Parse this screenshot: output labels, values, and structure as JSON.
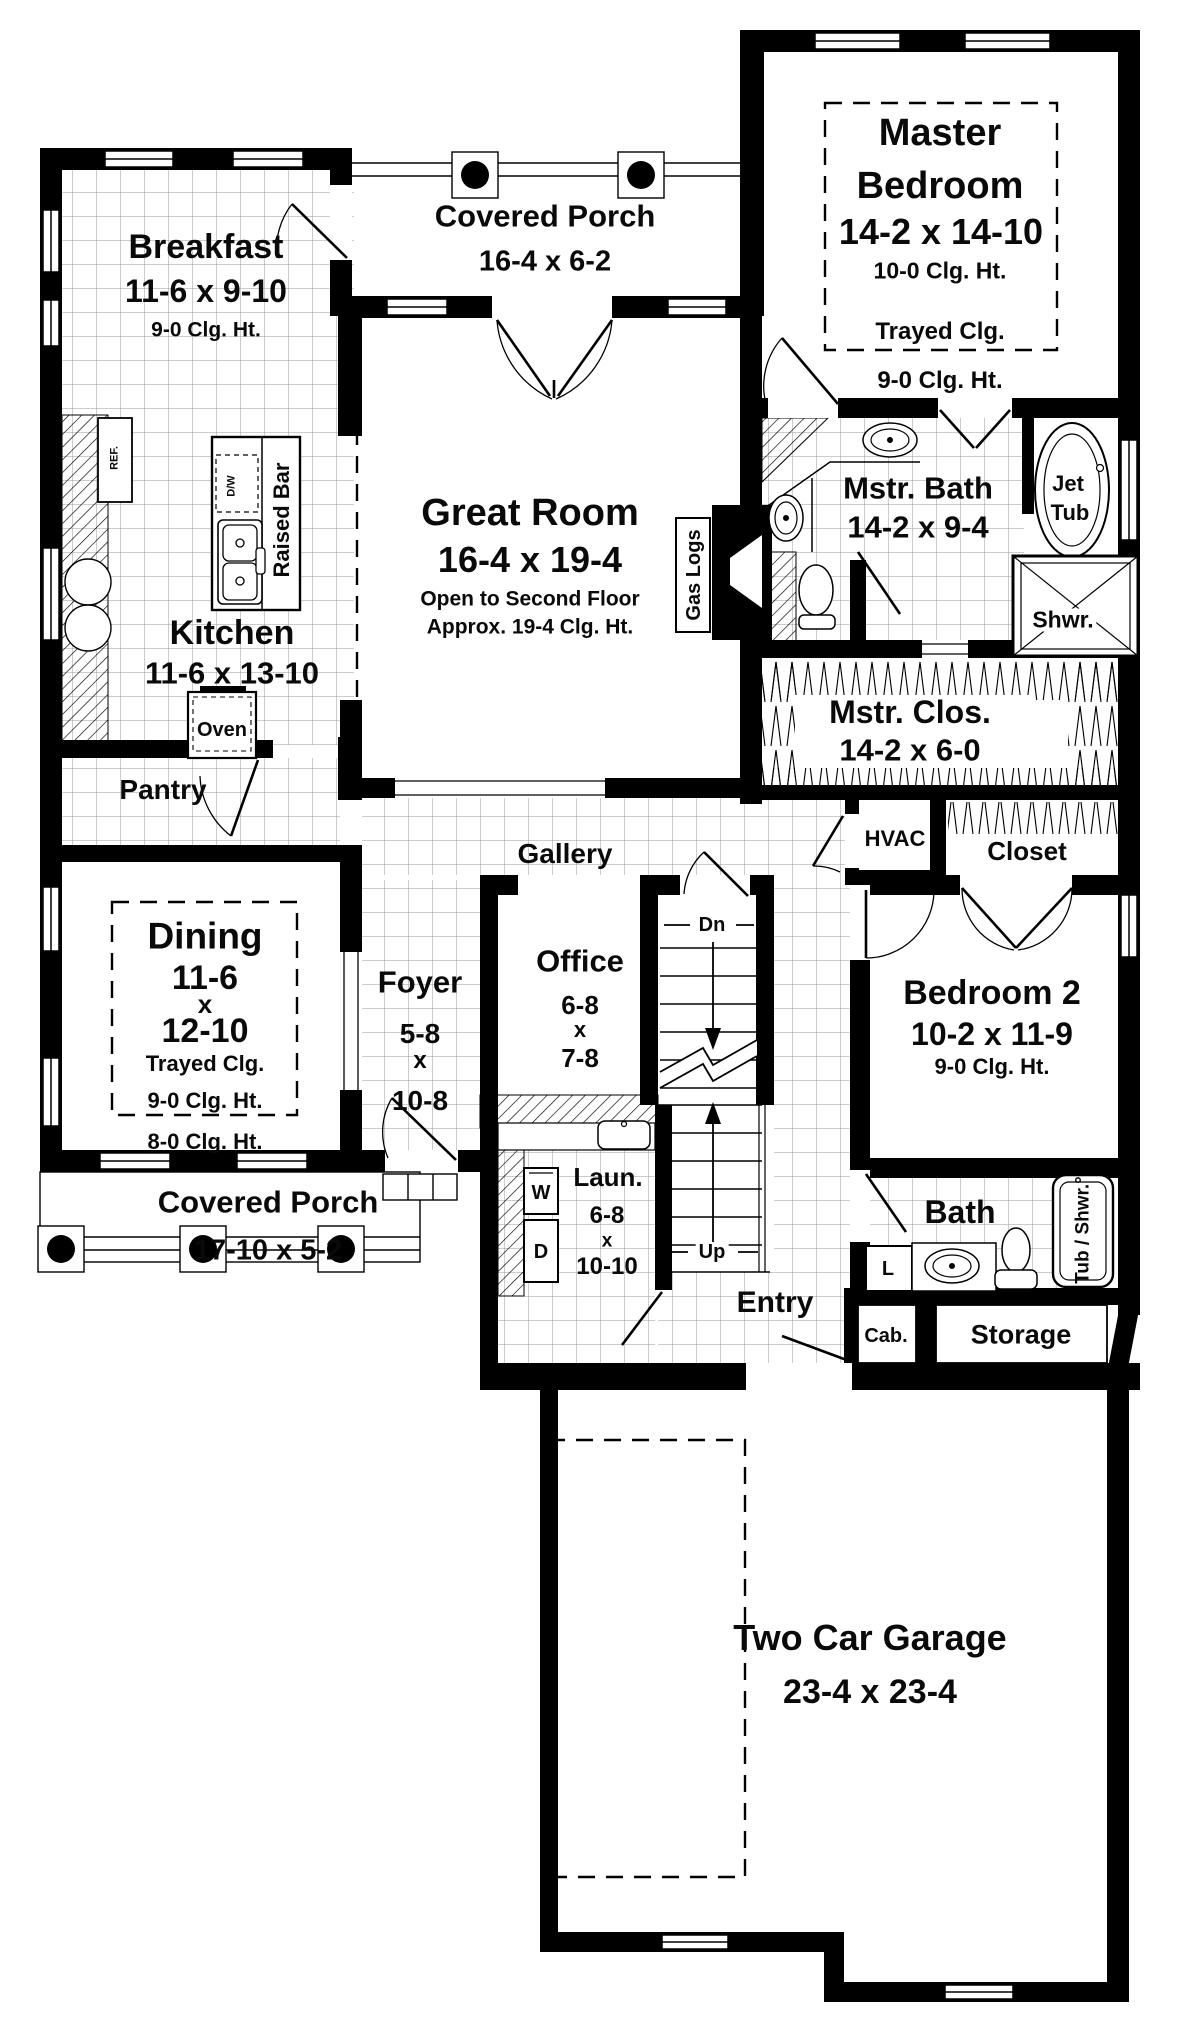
{
  "rooms": {
    "breakfast": {
      "name": "Breakfast",
      "dims": "11-6 x 9-10",
      "clg": "9-0 Clg. Ht."
    },
    "covered_porch_top": {
      "name": "Covered Porch",
      "dims": "16-4 x 6-2"
    },
    "master_bedroom": {
      "name1": "Master",
      "name2": "Bedroom",
      "dims": "14-2 x 14-10",
      "clg": "10-0 Clg. Ht.",
      "trayed": "Trayed Clg.",
      "clg2": "9-0 Clg. Ht."
    },
    "master_bath": {
      "name": "Mstr. Bath",
      "dims": "14-2 x 9-4",
      "jet1": "Jet",
      "jet2": "Tub",
      "shower": "Shwr."
    },
    "great_room": {
      "name": "Great Room",
      "dims": "16-4 x 19-4",
      "note1": "Open to Second Floor",
      "note2": "Approx. 19-4 Clg. Ht.",
      "gas_logs": "Gas Logs"
    },
    "kitchen": {
      "name": "Kitchen",
      "dims": "11-6 x 13-10",
      "raised_bar": "Raised Bar",
      "oven": "Oven",
      "ref": "REF.",
      "dw": "D/W"
    },
    "pantry": {
      "name": "Pantry"
    },
    "master_closet": {
      "name": "Mstr. Clos.",
      "dims": "14-2 x 6-0"
    },
    "hvac": {
      "name": "HVAC"
    },
    "closet": {
      "name": "Closet"
    },
    "gallery": {
      "name": "Gallery"
    },
    "dining": {
      "name": "Dining",
      "dim1": "11-6",
      "sep": "x",
      "dim2": "12-10",
      "trayed": "Trayed Clg.",
      "clg": "9-0 Clg. Ht.",
      "clg2": "8-0 Clg. Ht."
    },
    "foyer": {
      "name": "Foyer",
      "dim1": "5-8",
      "sep": "x",
      "dim2": "10-8"
    },
    "office": {
      "name": "Office",
      "dim1": "6-8",
      "sep": "x",
      "dim2": "7-8"
    },
    "stairs": {
      "dn": "Dn",
      "up": "Up"
    },
    "bedroom2": {
      "name": "Bedroom 2",
      "dims": "10-2 x 11-9",
      "clg": "9-0 Clg. Ht."
    },
    "laundry": {
      "name": "Laun.",
      "dim1": "6-8",
      "sep": "x",
      "dim2": "10-10",
      "washer": "W",
      "dryer": "D"
    },
    "entry": {
      "name": "Entry"
    },
    "bath2": {
      "name": "Bath",
      "linen": "L",
      "tub": "Tub / Shwr.°",
      "cab": "Cab."
    },
    "storage": {
      "name": "Storage"
    },
    "covered_porch_bottom": {
      "name": "Covered Porch",
      "dims": "17-10 x 5-2"
    },
    "garage": {
      "name": "Two Car Garage",
      "dims": "23-4 x 23-4"
    }
  },
  "colors": {
    "wall": "#000000",
    "grid_line": "#999999",
    "background": "#ffffff"
  }
}
